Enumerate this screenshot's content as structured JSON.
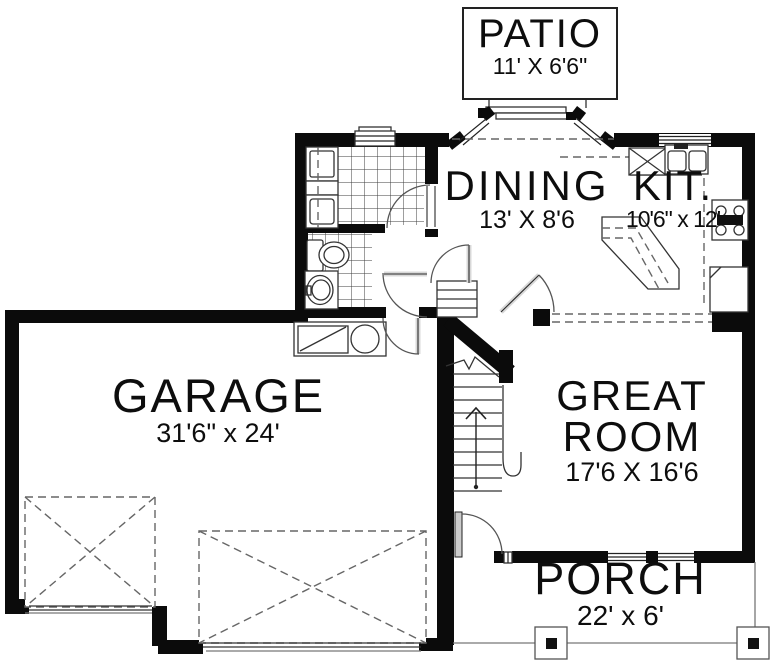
{
  "rooms": {
    "patio": {
      "name": "PATIO",
      "dims": "11' X 6'6\""
    },
    "dining": {
      "name": "DINING",
      "dims": "13' X 8'6"
    },
    "kitchen": {
      "name": "KIT.",
      "dims": "10'6\" x 12'"
    },
    "garage": {
      "name": "GARAGE",
      "dims": "31'6\" x 24'"
    },
    "great_room": {
      "name": "GREAT ROOM",
      "dims": "17'6 X 16'6"
    },
    "porch": {
      "name": "PORCH",
      "dims": "22' x 6'"
    }
  },
  "fixtures": [
    "washer",
    "dryer",
    "laundry-window",
    "toilet",
    "bathroom-sink",
    "utility-sink",
    "workbench",
    "dishwasher",
    "kitchen-sink",
    "kitchen-window",
    "stove",
    "refrigerator",
    "kitchen-island",
    "pantry-shelves",
    "stairs",
    "patio-sliding-door",
    "bay-windows",
    "front-door",
    "garage-single-door",
    "garage-double-door",
    "parking-stall-x",
    "porch-posts"
  ],
  "colors": {
    "walls": "#0b0b0b",
    "thin_lines": "#333333",
    "light_lines": "#777777",
    "dashed_lines": "#666666",
    "door_leaf": "#d8d8d8",
    "background": "#ffffff"
  }
}
